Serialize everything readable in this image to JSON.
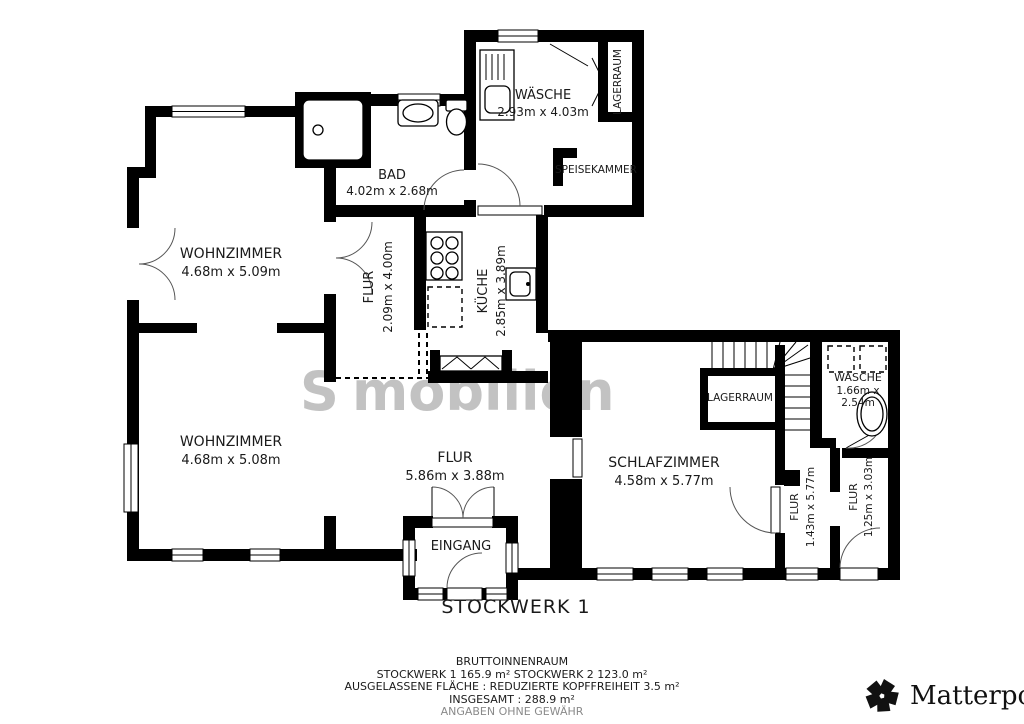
{
  "plan": {
    "title": "STOCKWERK 1",
    "watermark": {
      "part1": "S",
      "part2": "mobilien"
    },
    "wall_color": "#000000",
    "rooms": {
      "waesche_top": {
        "name": "WÄSCHE",
        "dims": "2.93m x 4.03m"
      },
      "lagerraum_top": {
        "name": "LAGERRAUM"
      },
      "speisekammer": {
        "name": "SPEISEKAMMER"
      },
      "bad": {
        "name": "BAD",
        "dims": "4.02m x 2.68m"
      },
      "wohnzimmer_1": {
        "name": "WOHNZIMMER",
        "dims": "4.68m x 5.09m"
      },
      "flur_1": {
        "name": "FLUR",
        "dims": "2.09m x 4.00m"
      },
      "kueche": {
        "name": "KÜCHE",
        "dims": "2.85m x 3.89m"
      },
      "wohnzimmer_2": {
        "name": "WOHNZIMMER",
        "dims": "4.68m x 5.08m"
      },
      "flur_2": {
        "name": "FLUR",
        "dims": "5.86m x 3.88m"
      },
      "schlafzimmer": {
        "name": "SCHLAFZIMMER",
        "dims": "4.58m x 5.77m"
      },
      "lagerraum_mid": {
        "name": "LAGERRAUM"
      },
      "waesche_right": {
        "name": "WÄSCHE",
        "dims_line1": "1.66m x",
        "dims_line2": "2.54m"
      },
      "flur_3": {
        "name": "FLUR",
        "dims": "1.43m x 5.77m"
      },
      "flur_4": {
        "name": "FLUR",
        "dims": "1.25m x 3.03m"
      },
      "eingang": {
        "name": "EINGANG"
      }
    },
    "footer": {
      "line1": "BRUTTOINNENRAUM",
      "line2": "STOCKWERK 1 165.9 m²   STOCKWERK 2 123.0 m²",
      "line3": "AUSGELASSENE FLÄCHE :  REDUZIERTE KOPFFREIHEIT 3.5 m²",
      "line4": "INSGESAMT :  288.9 m²",
      "line5": "ANGABEN OHNE GEWÄHR"
    },
    "brand": {
      "name": "Matterport",
      "registered": "®"
    }
  }
}
